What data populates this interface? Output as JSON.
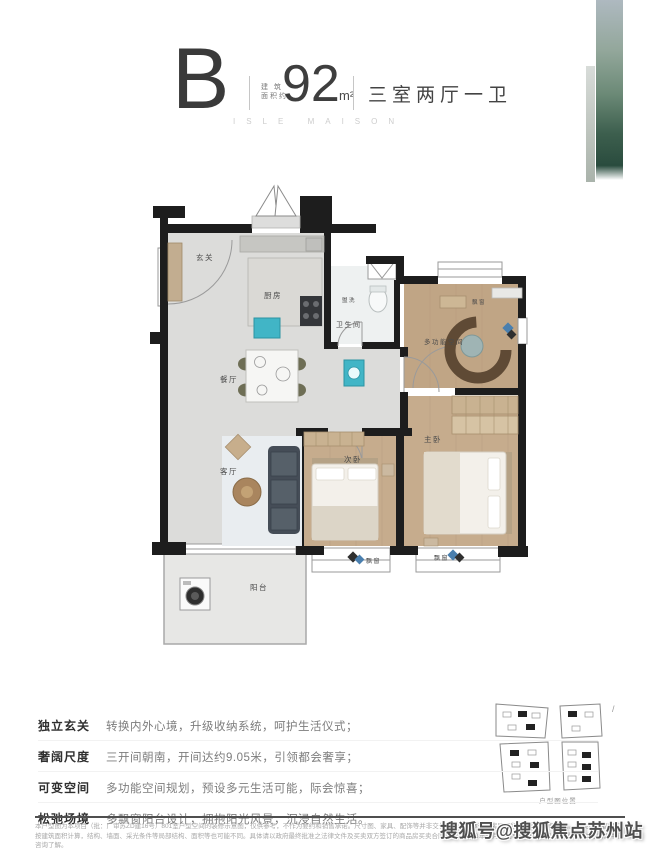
{
  "header": {
    "plan_letter": "B",
    "area_label_line1": "建 筑",
    "area_label_line2": "面积约",
    "area_value": "92",
    "area_unit": "m²",
    "layout": "三室两厅一卫",
    "series_caption": "ISLE MAISON"
  },
  "floorplan": {
    "labels": {
      "entry": "玄关",
      "kitchen": "厨房",
      "vanity": "盥洗",
      "bathroom": "卫生间",
      "dining": "餐厅",
      "living": "客厅",
      "balcony": "阳台",
      "bedroom2": "次卧",
      "master": "主卧",
      "multi_function": "多功能空间",
      "bay_window": "飘窗"
    }
  },
  "features": {
    "items": [
      {
        "label": "独立玄关",
        "desc": "转换内外心境，升级收纳系统，呵护生活仪式；"
      },
      {
        "label": "奢阔尺度",
        "desc": "三开间朝南，开间达约9.05米，引领都会奢享；"
      },
      {
        "label": "可变空间",
        "desc": "多功能空间规划，预设多元生活可能，际会惊喜；"
      },
      {
        "label": "松弛场境",
        "desc": "多飘窗阳台设计，拥抱阳光风景，沉浸自然生活。"
      }
    ]
  },
  "keyplate": {
    "caption": "户型图位置",
    "slash": "/"
  },
  "disclaimer": {
    "text": "本户型图为本项目（批：广审苏ZD建16号）801室户型空间的装修示意图，仅供参考，不作为要约和销售承诺。尺寸图、家具、配饰等并非交付标准，具体选购房屋因所在位置不同而不同。相关户型面积均按建筑面积计算，结构、墙面、采光条件等局部结构、面积等也可能不同。具体请以政府最终批准之法律文件及买卖双方签订的商品房买卖合同为准。2023年10月23日模型更新不再另行通知，请至营销中心咨询了解。"
  },
  "watermark": "搜狐号@搜狐焦点苏州站",
  "colors": {
    "accent_teal": "#41b5c6",
    "wall": "#1d1d1d",
    "wood": "#c6ac8d",
    "marble": "#dcdcda",
    "strip_green_dark": "#2a4c3e",
    "strip_blue_light": "#aeb9c0"
  }
}
